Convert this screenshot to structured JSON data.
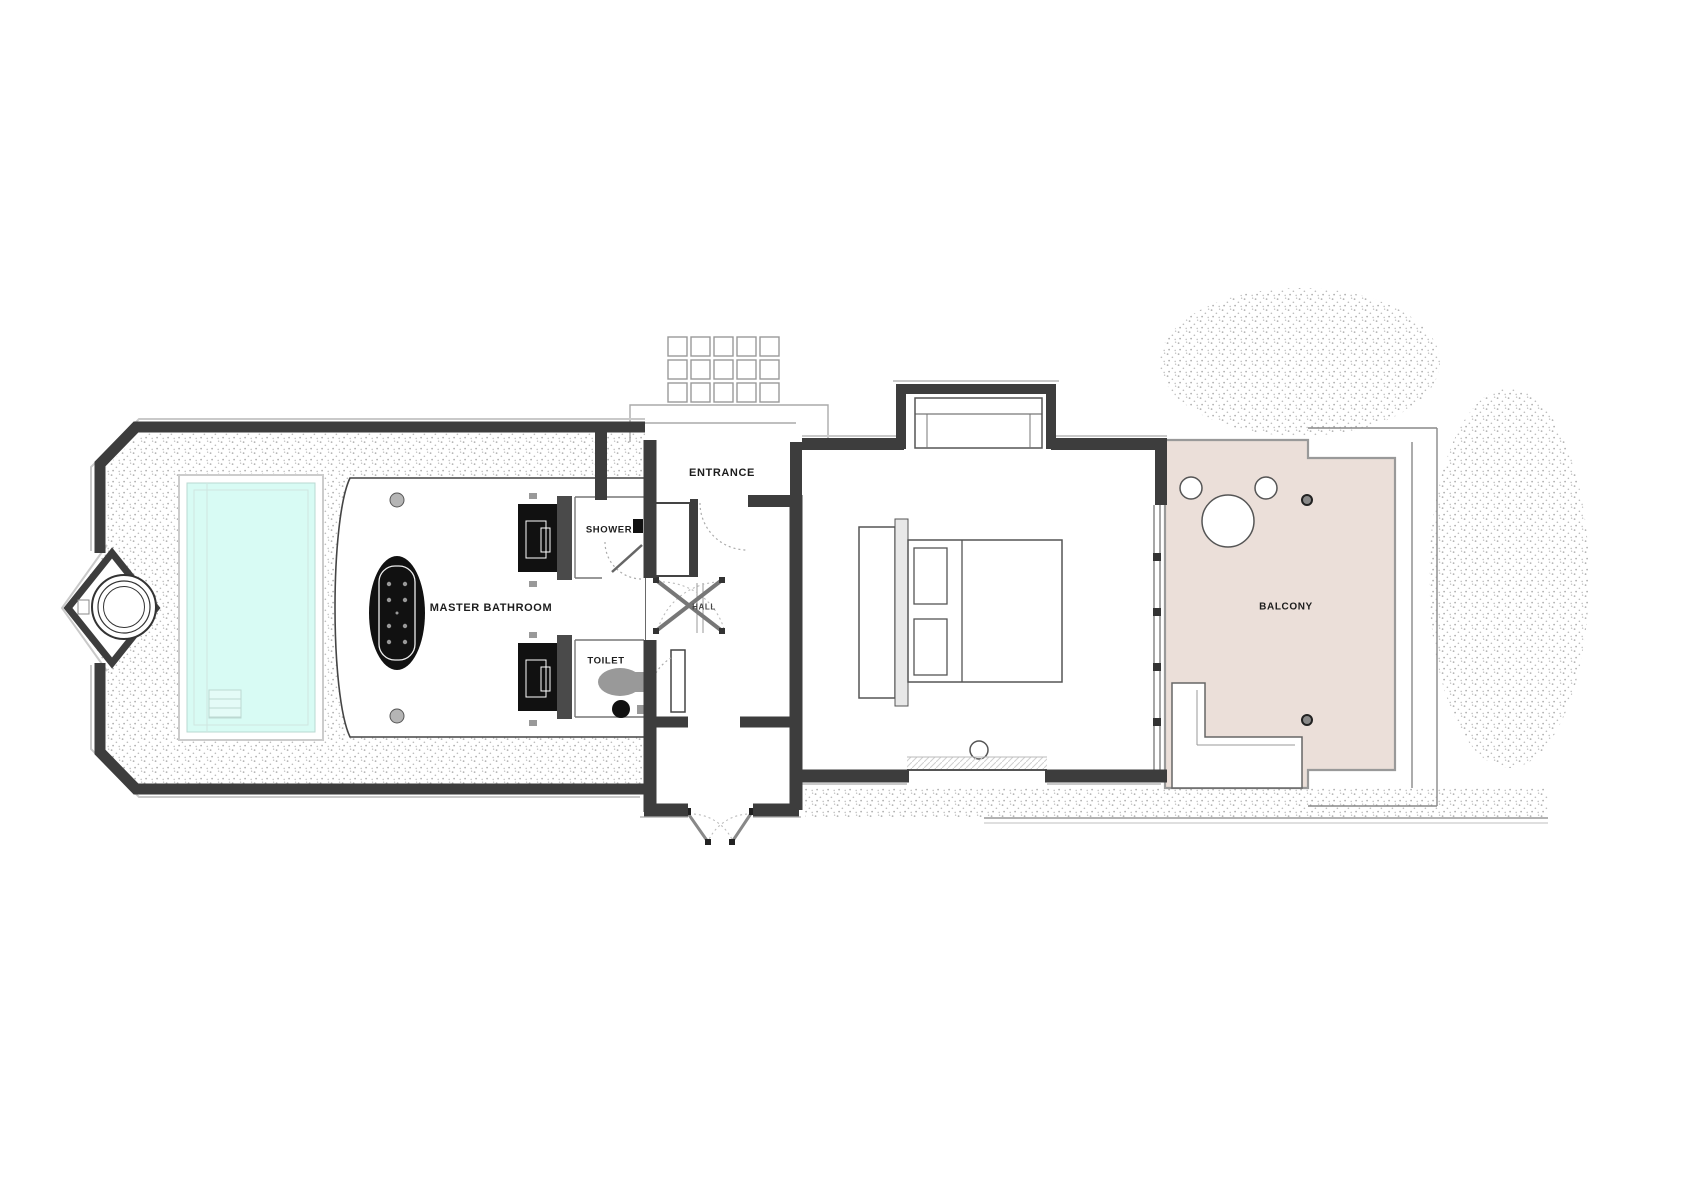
{
  "plan": {
    "type": "architectural-floor-plan",
    "rooms": {
      "entrance": "ENTRANCE",
      "master_bathroom": "MASTER BATHROOM",
      "shower": "SHOWER",
      "toilet": "TOILET",
      "hall": "HALL",
      "balcony": "BALCONY"
    },
    "fixtures": [
      "plunge-pool",
      "outdoor-bath-pavilion",
      "oval-bathtub",
      "vanity-basin-top",
      "vanity-basin-bottom",
      "shower-head",
      "toilet-bowl",
      "double-bed",
      "pillows",
      "wardrobe",
      "stepping-stones",
      "entrance-canopy",
      "double-swing-doors",
      "sliding-glass-doors",
      "balcony-round-table",
      "balcony-chairs",
      "balcony-lounger"
    ],
    "colors": {
      "wall": "#3d3d3d",
      "wall_offset": "#c9c9c9",
      "pool_water": "#d8fbf4",
      "balcony_deck": "#ebdfd9",
      "fixture_dark": "#111111",
      "fixture_grey": "#999999",
      "stipple_dot": "#b0b0b0"
    }
  }
}
